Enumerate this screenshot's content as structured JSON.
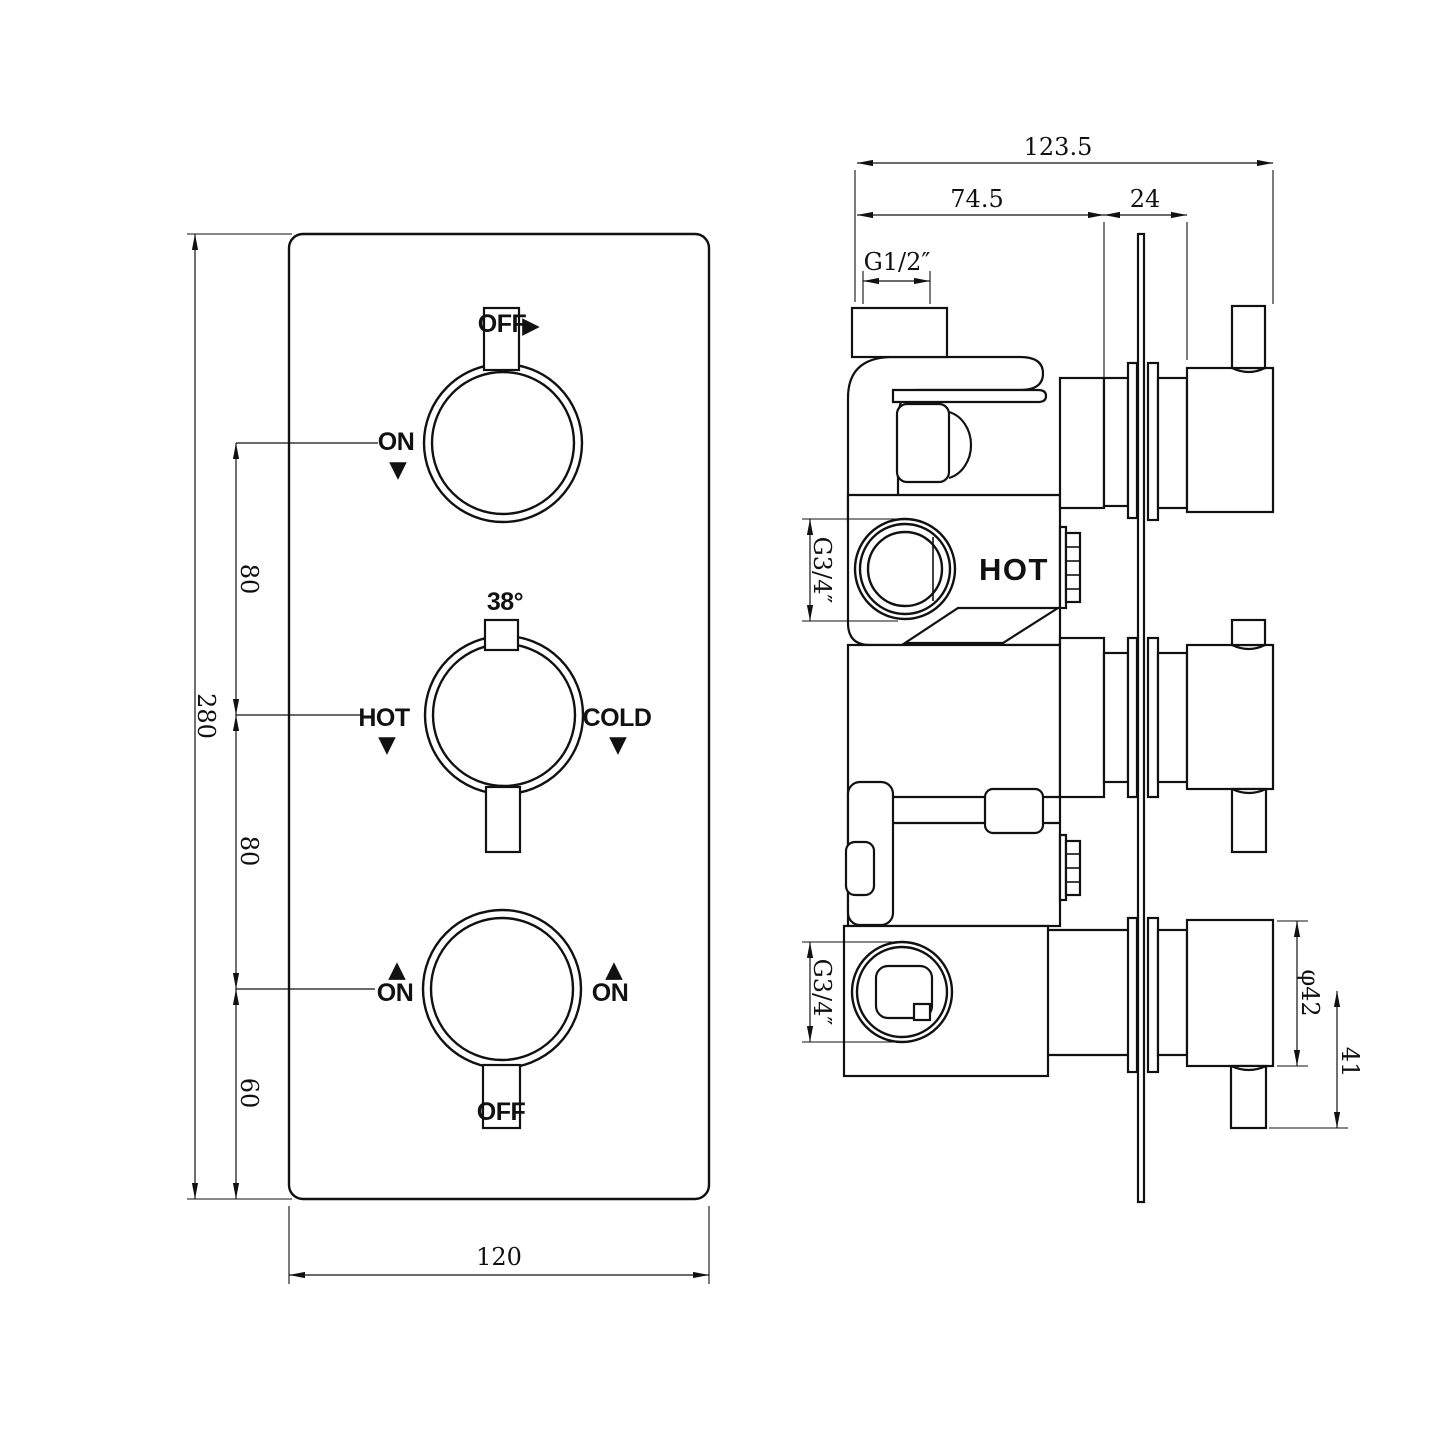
{
  "front": {
    "dims": {
      "height": "280",
      "seg_top": "80",
      "seg_mid": "80",
      "seg_bot": "60",
      "width": "120"
    },
    "knob_top": {
      "off": "OFF",
      "on": "ON"
    },
    "knob_mid": {
      "temp": "38°",
      "hot": "HOT",
      "cold": "COLD"
    },
    "knob_bot": {
      "on_left": "ON",
      "on_right": "ON",
      "off": "OFF"
    }
  },
  "side": {
    "dims": {
      "total_width": "123.5",
      "body_depth": "74.5",
      "plate_to_knob": "24",
      "thread_top": "G1/2″",
      "thread_hot": "G3/4″",
      "thread_cold": "G3/4″",
      "knob_diameter": "φ42",
      "knob_depth": "41"
    },
    "hot_label": "HOT"
  },
  "glyphs": {
    "down": "▼",
    "up": "▲",
    "right": "▶"
  }
}
